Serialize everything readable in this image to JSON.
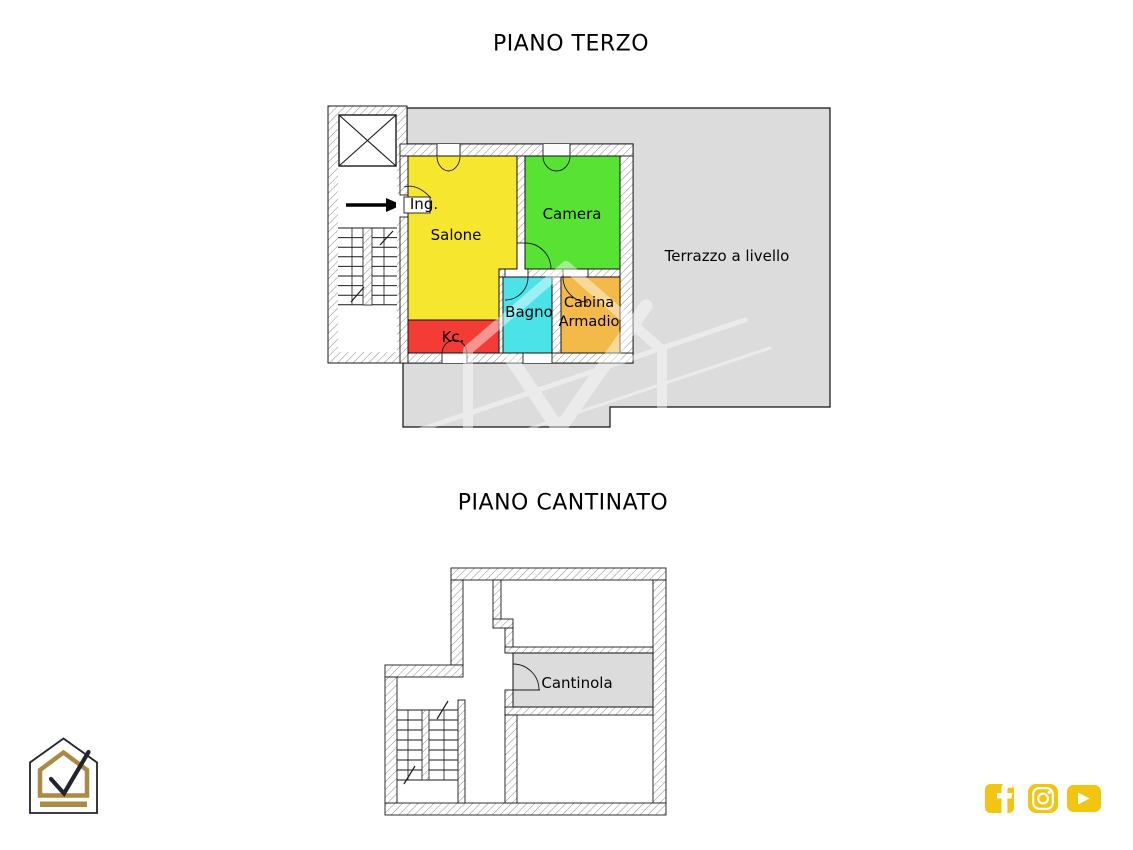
{
  "document": {
    "type": "floor-plan-flyer",
    "background": "#ffffff"
  },
  "plans": {
    "terzo": {
      "title": "PIANO TERZO",
      "rooms": {
        "ing": "Ing.",
        "salone": "Salone",
        "kc": "Kc.",
        "camera": "Camera",
        "bagno": "Bagno",
        "cabina_armadio_line1": "Cabina",
        "cabina_armadio_line2": "Armadio",
        "terrazzo": "Terrazzo a livello"
      }
    },
    "cantinato": {
      "title": "PIANO CANTINATO",
      "rooms": {
        "cantinola": "Cantinola"
      }
    }
  },
  "colors": {
    "salone": "#f6e62e",
    "kc": "#f23c35",
    "camera": "#57e234",
    "bagno": "#4be2e8",
    "cabina_armadio": "#f4ba49",
    "terrace": "#dcdcdc",
    "cantinola_fill": "#dcdcdc",
    "social_yellow": "#f3c513",
    "logo_gold": "#ab8a43",
    "logo_dark": "#23232d"
  },
  "footer": {
    "social_icons": [
      {
        "name": "facebook"
      },
      {
        "name": "instagram"
      },
      {
        "name": "youtube"
      }
    ]
  }
}
